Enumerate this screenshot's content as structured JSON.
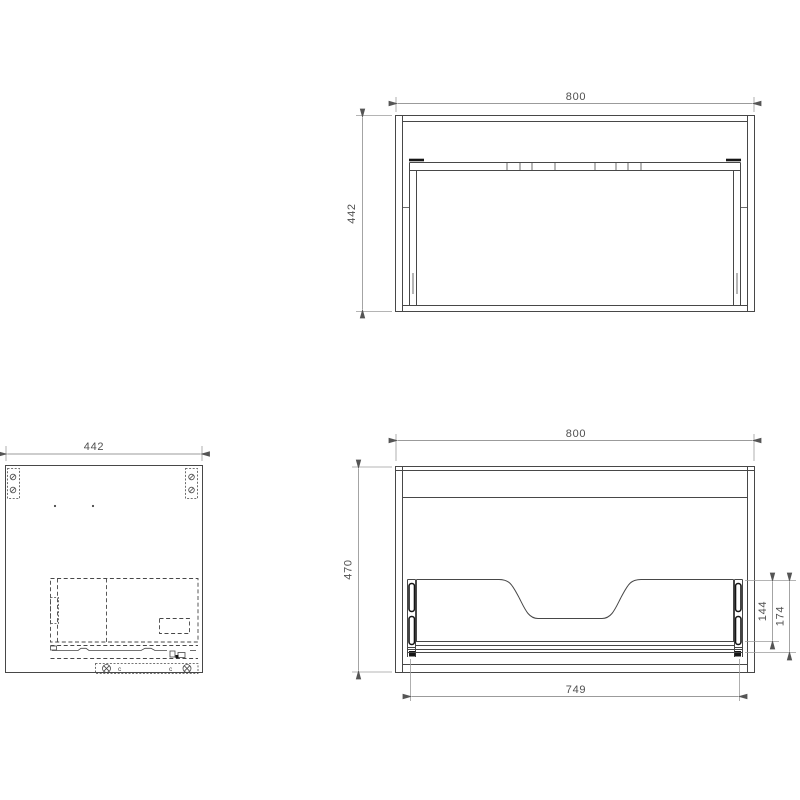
{
  "views": {
    "plan": {
      "width": "800",
      "depth": "442"
    },
    "side": {
      "depth": "442",
      "fastener_marks": [
        "c",
        "c"
      ]
    },
    "front": {
      "width": "800",
      "height": "470",
      "drawer_width": "749",
      "cutout_height": "144",
      "drawer_back_height": "174"
    }
  },
  "colors": {
    "line": "#474747",
    "detail": "#161616",
    "dim": "#9b9b9b",
    "text": "#4f4f4f",
    "bg": "#ffffff"
  }
}
